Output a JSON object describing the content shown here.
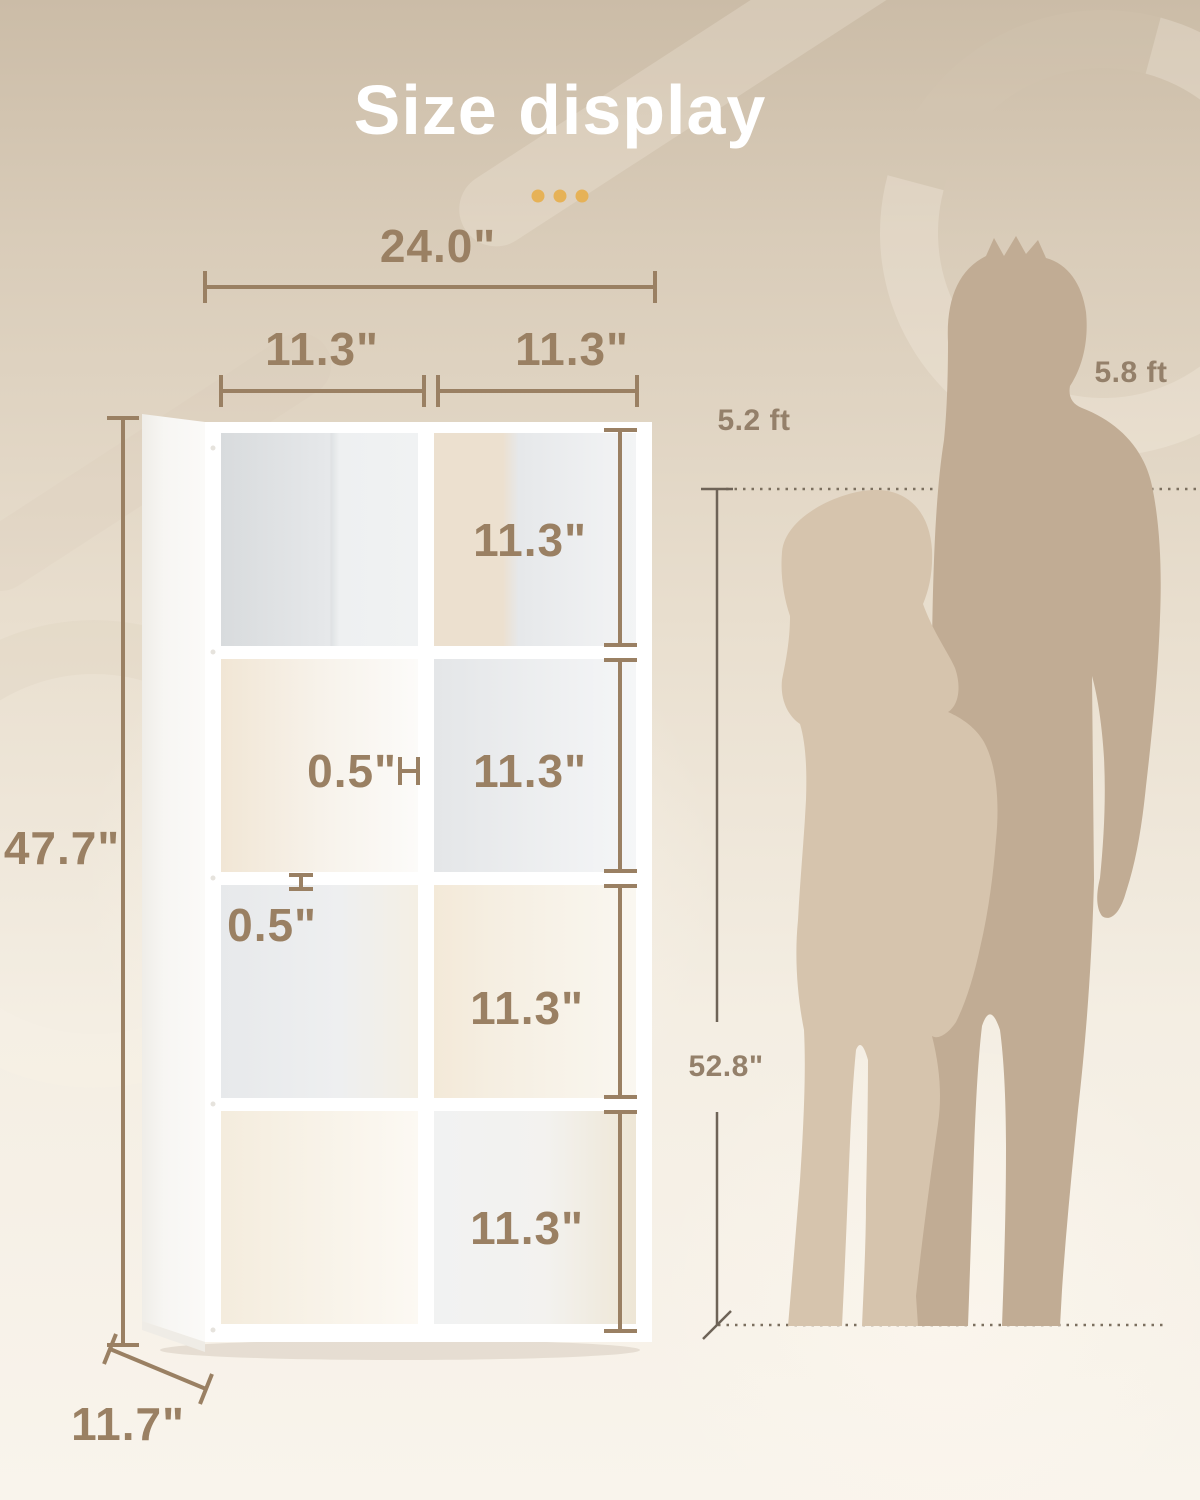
{
  "title": "Size display",
  "colors": {
    "accent_dots": "#E6B257",
    "dimension_text": "#9A8063",
    "reference_line": "#6E6357",
    "woman_silhouette": "#D6C4AD",
    "man_silhouette": "#C1AC94"
  },
  "bookshelf": {
    "total_width": "24.0\"",
    "top_cube_width_left": "11.3\"",
    "top_cube_width_right": "11.3\"",
    "total_height": "47.7\"",
    "depth": "11.7\"",
    "divider_thickness": "0.5\"",
    "shelf_thickness": "0.5\"",
    "cube_height_row1": "11.3\"",
    "cube_height_row2": "11.3\"",
    "cube_height_row3": "11.3\"",
    "cube_height_row4": "11.3\""
  },
  "people": {
    "woman_height": "5.2 ft",
    "man_height": "5.8 ft",
    "reference_height": "52.8\""
  }
}
